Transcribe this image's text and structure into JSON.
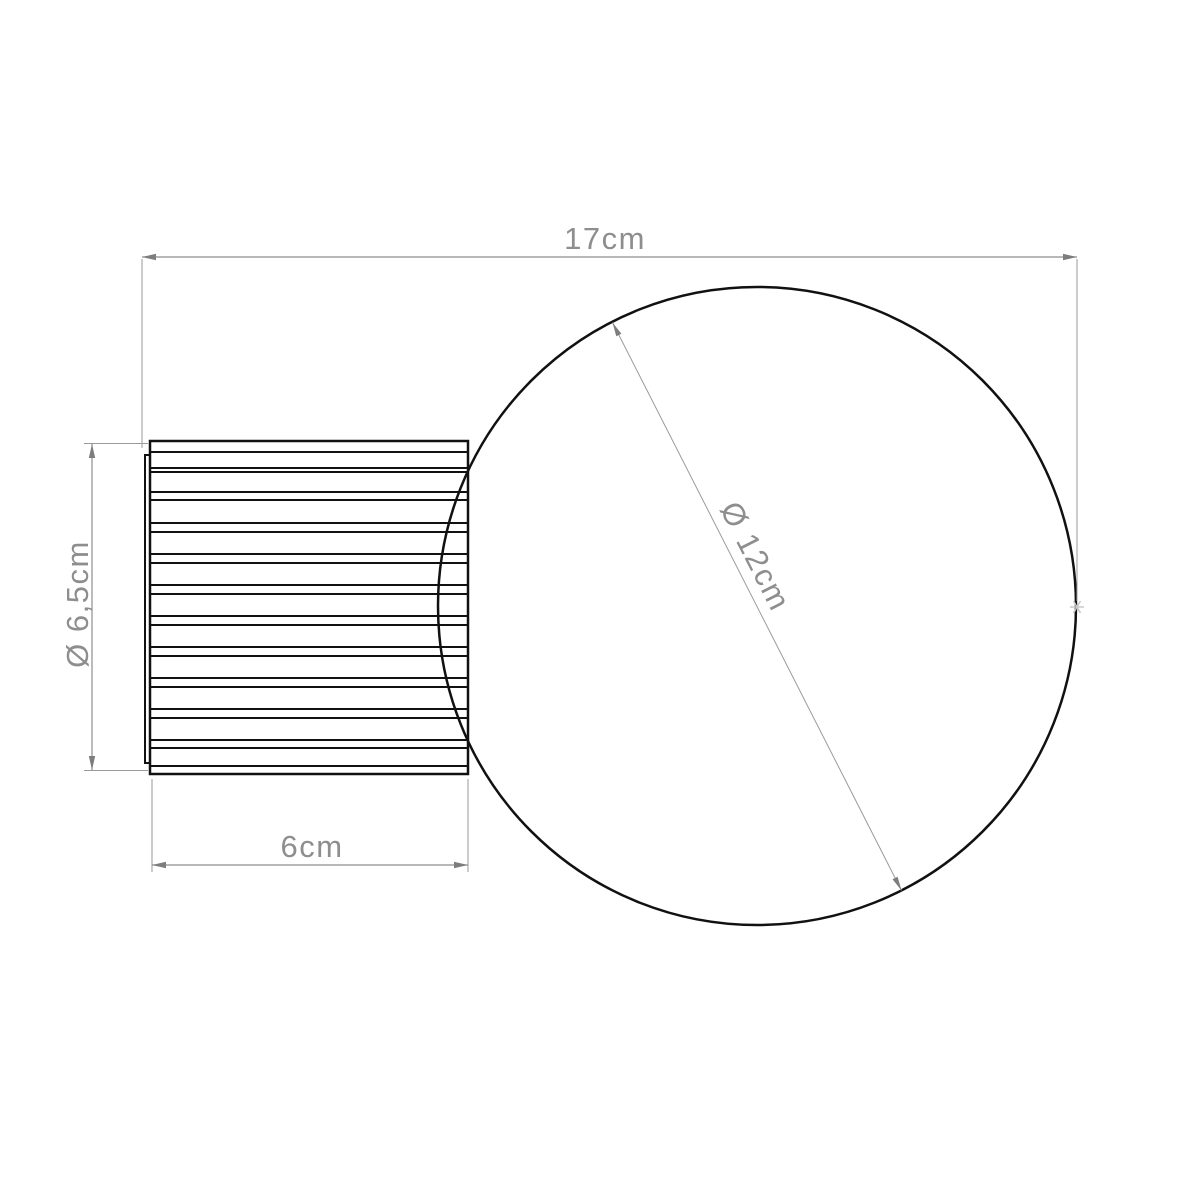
{
  "drawing": {
    "labels": {
      "overall_width": "17cm",
      "sphere_diameter": "Ø 12cm",
      "base_diameter": "Ø 6,5cm",
      "base_depth": "6cm"
    },
    "colors": {
      "outline": "#111111",
      "dimension": "#8e8e8e",
      "background": "#ffffff"
    }
  }
}
